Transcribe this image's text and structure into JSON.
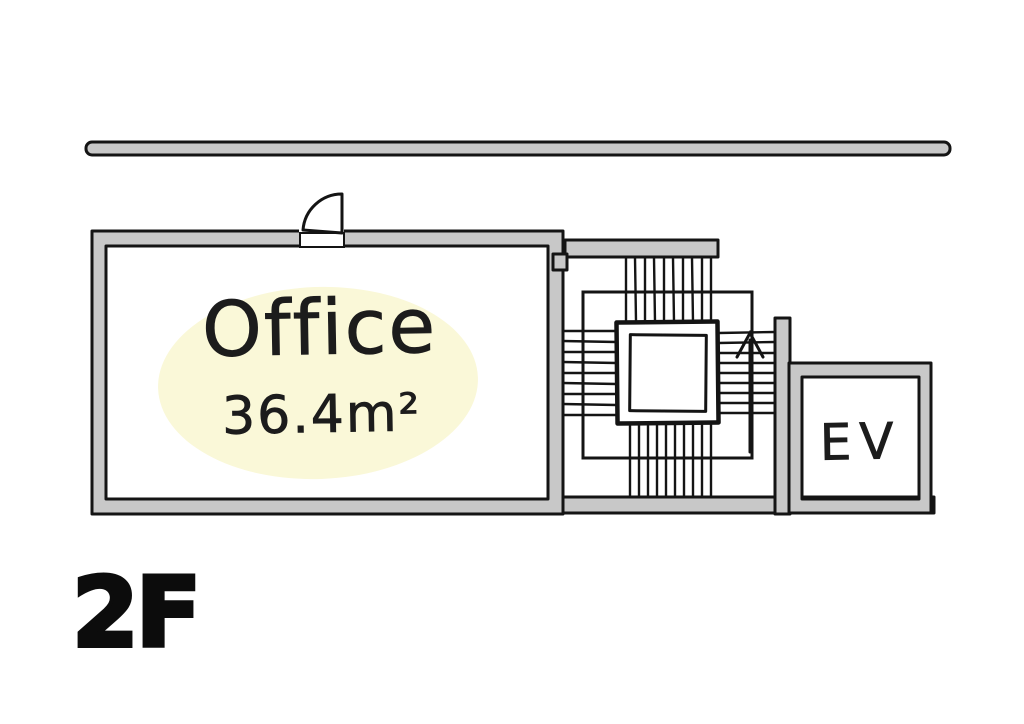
{
  "plan": {
    "floor_label": "2F",
    "rooms": {
      "office": {
        "name": "Office",
        "area": "36.4m²"
      },
      "elevator": {
        "label": "EV"
      },
      "stairwell": {
        "direction": "up"
      }
    }
  },
  "colors": {
    "wall_fill": "#c8c8c8",
    "line": "#141414",
    "highlight": "#faf8d8",
    "text": "#1c1c1c"
  }
}
